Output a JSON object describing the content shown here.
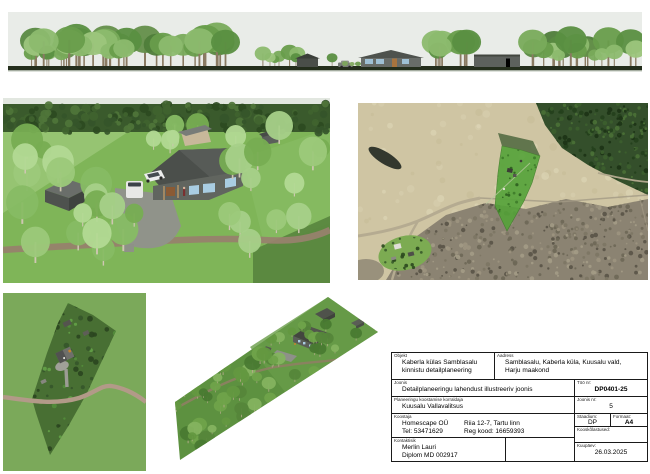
{
  "titleblock": {
    "objekt_label": "Objekt",
    "objekt_line1": "Kaberla külas Samblasalu",
    "objekt_line2": "kinnistu detailplaneering",
    "aadress_label": "Aadress",
    "aadress_line1": "Samblasalu, Kaberla küla, Kuusalu vald,",
    "aadress_line2": "Harju maakond",
    "joonis_label": "Joonis",
    "joonis_value": "Detailplaneeringu lahendust illustreeriv joonis",
    "korraldaja_label": "Planeeringu koostamise korraldaja",
    "korraldaja_value": "Kuusalu Vallavalitsus",
    "koostaja_label": "Koostaja",
    "koostaja_name": "Homescape OÜ",
    "koostaja_address": "Riia 12-7, Tartu linn",
    "koostaja_tel": "Tel: 53471629",
    "koostaja_reg": "Reg kood: 16659393",
    "kontakt_label": "Kontaktisik",
    "kontakt_name": "Merlin Lauri",
    "kontakt_cred": "Diplom MD 002917",
    "too_nr_label": "Töö nr:",
    "too_nr_value": "DP0401-25",
    "joonis_nr_label": "Joonis nr:",
    "joonis_nr_value": "5",
    "staadium_label": "Staadium:",
    "staadium_value": "DP",
    "formaat_label": "Formaat:",
    "formaat_value": "A4",
    "kooskolastused_label": "Kooskõlastused:",
    "kuupaev_label": "Kuupäev:",
    "kuupaev_value": "26.03.2025"
  },
  "colors": {
    "sky": "#e9ece8",
    "parcel_highlight": "#55a339",
    "lawn": "#7fb558",
    "forest_dark": "#3a5a2c"
  }
}
